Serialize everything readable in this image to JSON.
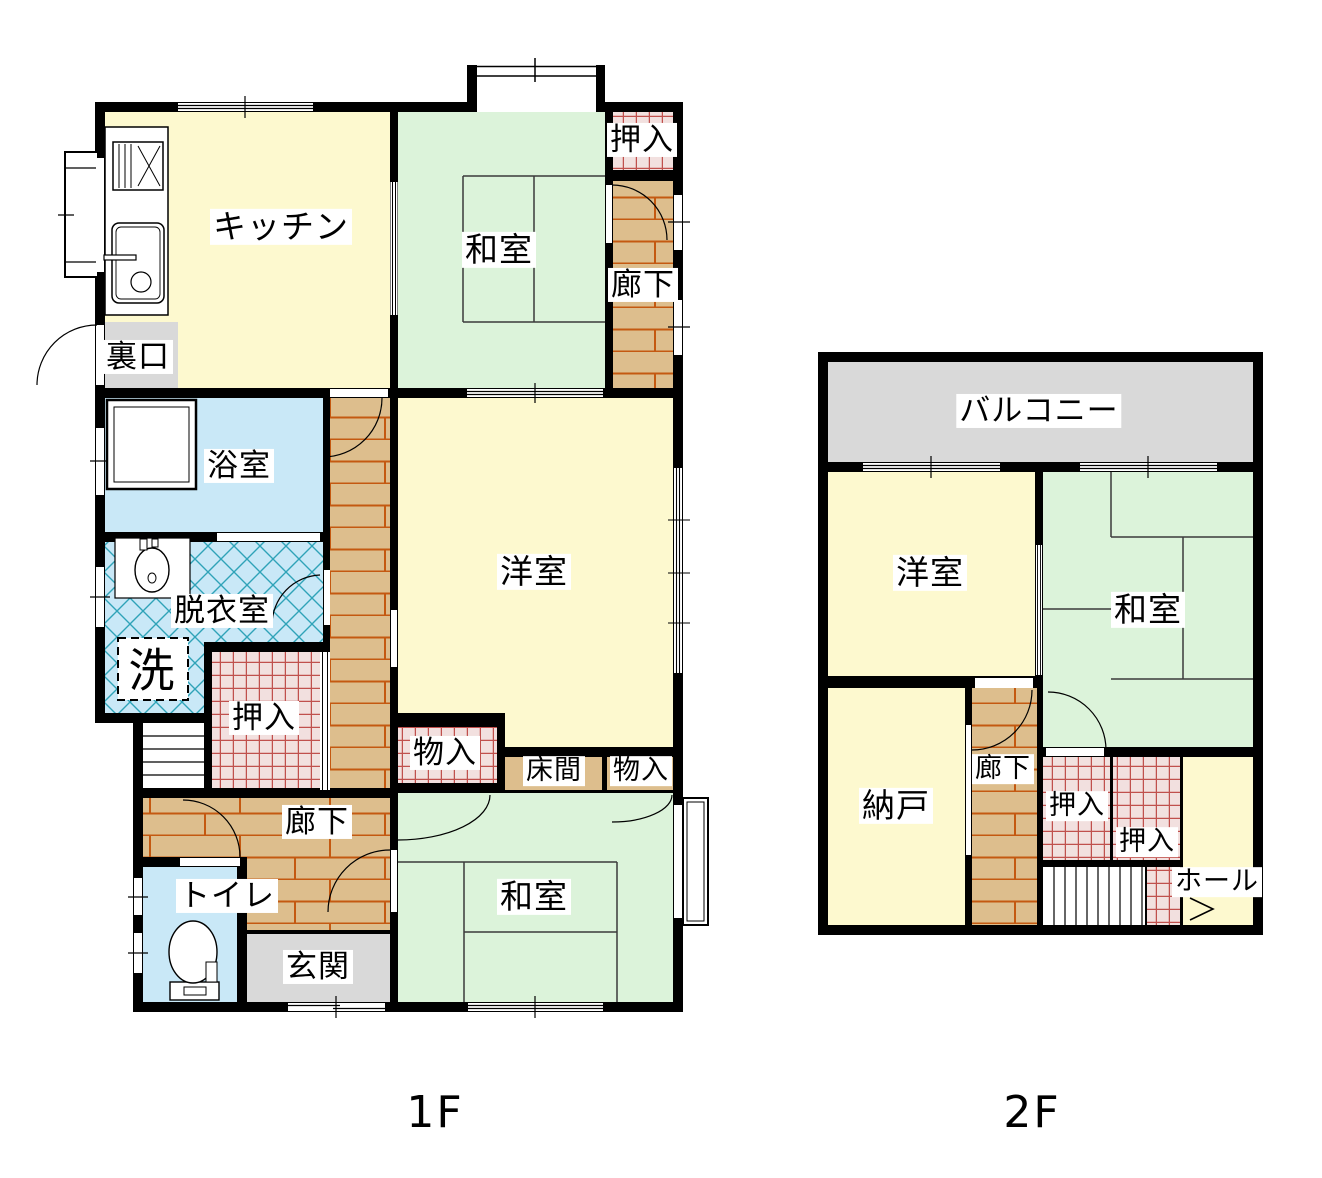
{
  "title": "間取り図 (floor plan)",
  "colors": {
    "wall": "#000000",
    "room_yellow": "#FDF9CF",
    "tatami_green": "#DCF3DA",
    "corridor_tan": "#DDBE8D",
    "brick_line": "#C45911",
    "closet_pink": "#F2E0DF",
    "closet_line": "#C0504D",
    "water_blue": "#C9E8F7",
    "hatch_line": "#2FA3B8",
    "gray_floor": "#D9D9D9",
    "tatami_line": "#3B3B3B",
    "white": "#FFFFFF"
  },
  "floor1": {
    "caption": "1F",
    "rooms": {
      "kitchen": "キッチン",
      "washitsu_north": "和室",
      "oshiire_ne": "押入",
      "rouka_east": "廊下",
      "uraguchi": "裏口",
      "yokushitsu": "浴室",
      "datsuishitsu": "脱衣室",
      "sen": "洗",
      "oshiire_mid": "押入",
      "monoire_west": "物入",
      "tokonoma": "床間",
      "monoire_east": "物入",
      "rouka_south": "廊下",
      "toilet": "トイレ",
      "genkan": "玄関",
      "youshitsu": "洋室",
      "washitsu_south": "和室"
    }
  },
  "floor2": {
    "caption": "2F",
    "rooms": {
      "balcony": "バルコニー",
      "youshitsu": "洋室",
      "washitsu": "和室",
      "nando": "納戸",
      "rouka": "廊下",
      "oshiire_a": "押入",
      "oshiire_b": "押入",
      "hall": "ホール"
    }
  }
}
